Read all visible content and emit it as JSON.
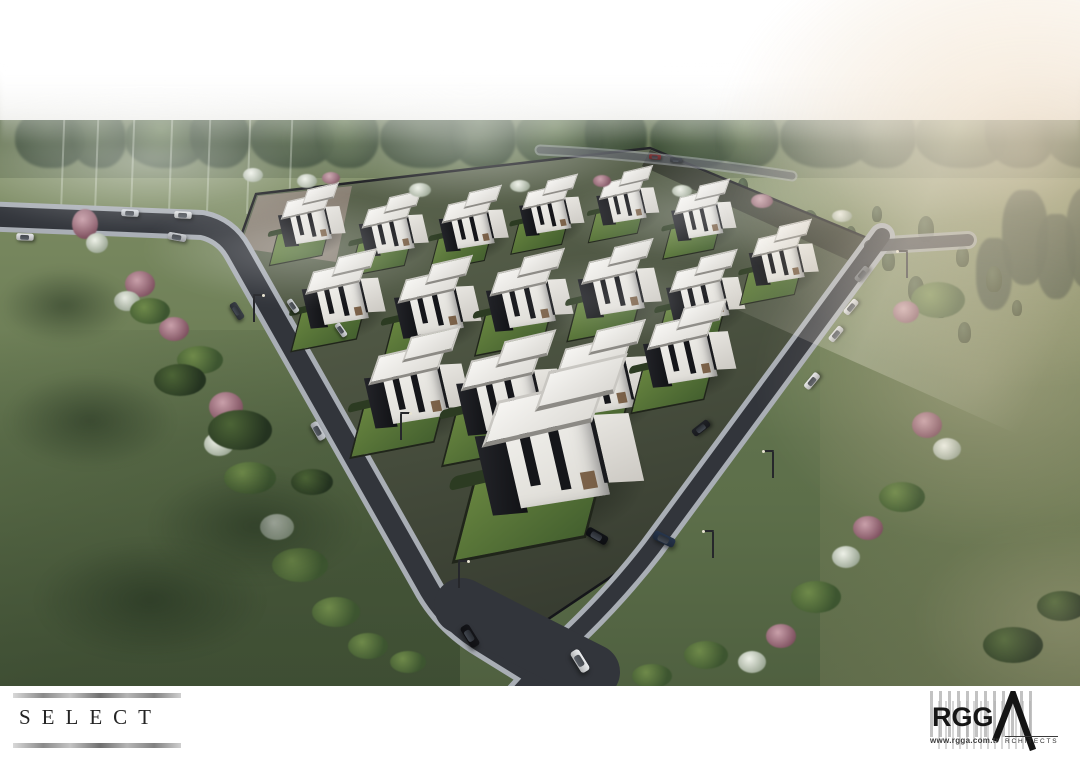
{
  "branding": {
    "select": {
      "label": "SELECT"
    },
    "rgga": {
      "name": "RGG",
      "architects_suffix": "RCHITECTS",
      "website": "www.rgga.com.tr"
    }
  },
  "palette": {
    "sky_white": "#ffffff",
    "fog_warm": "#e7d2b7",
    "grass_light": "#7c8b62",
    "grass_dark": "#4f6040",
    "treeline": "#3d4f35",
    "asphalt": "#32353b",
    "sidewalk": "#a9aeb5",
    "villa_white": "#f2f1ed",
    "villa_dark": "#15161a",
    "lawn_green": "#5d7a42",
    "logo_ink": "#161616"
  },
  "scene": {
    "description": "Aerial 3D architectural rendering of the SELECT villa estate: triangular fenced plot of modern white cubic duplex villas with black accents and flat roofs, wrapped by two diagonal roads with cars and street lamps, set in foggy green meadows with a pine treeline and warm sunlight from the upper right.",
    "villas": [
      {
        "x": 312,
        "y": 224,
        "s": 0.58
      },
      {
        "x": 394,
        "y": 233,
        "s": 0.6
      },
      {
        "x": 474,
        "y": 228,
        "s": 0.6
      },
      {
        "x": 552,
        "y": 214,
        "s": 0.56
      },
      {
        "x": 628,
        "y": 204,
        "s": 0.54
      },
      {
        "x": 704,
        "y": 219,
        "s": 0.56
      },
      {
        "x": 344,
        "y": 300,
        "s": 0.72
      },
      {
        "x": 438,
        "y": 309,
        "s": 0.75
      },
      {
        "x": 530,
        "y": 302,
        "s": 0.75
      },
      {
        "x": 620,
        "y": 290,
        "s": 0.72
      },
      {
        "x": 706,
        "y": 298,
        "s": 0.68
      },
      {
        "x": 784,
        "y": 262,
        "s": 0.6
      },
      {
        "x": 418,
        "y": 392,
        "s": 0.92
      },
      {
        "x": 512,
        "y": 398,
        "s": 0.95
      },
      {
        "x": 604,
        "y": 384,
        "s": 0.9
      },
      {
        "x": 690,
        "y": 356,
        "s": 0.8
      },
      {
        "x": 560,
        "y": 458,
        "s": 1.45
      }
    ],
    "cars": [
      {
        "x": 25,
        "y": 237,
        "a": 2,
        "c": "#e9eaec",
        "s": 0.8
      },
      {
        "x": 130,
        "y": 213,
        "a": 3,
        "c": "#dde1e6",
        "s": 0.8
      },
      {
        "x": 183,
        "y": 215,
        "a": 3,
        "c": "#e7e9eb",
        "s": 0.8
      },
      {
        "x": 177,
        "y": 237,
        "a": 10,
        "c": "#c7cacf",
        "s": 0.85
      },
      {
        "x": 237,
        "y": 311,
        "a": 58,
        "c": "#393e45",
        "s": 0.85
      },
      {
        "x": 318,
        "y": 431,
        "a": 60,
        "c": "#c6cad0",
        "s": 0.9
      },
      {
        "x": 470,
        "y": 636,
        "a": 58,
        "c": "#141519",
        "s": 1.1
      },
      {
        "x": 597,
        "y": 536,
        "a": 30,
        "c": "#111317",
        "s": 1.05
      },
      {
        "x": 664,
        "y": 539,
        "a": 26,
        "c": "#26354c",
        "s": 1.05
      },
      {
        "x": 580,
        "y": 661,
        "a": 58,
        "c": "#eef0f2",
        "s": 1.1
      },
      {
        "x": 862,
        "y": 274,
        "a": -50,
        "c": "#6e737a",
        "s": 0.8
      },
      {
        "x": 851,
        "y": 307,
        "a": -50,
        "c": "#e8eaec",
        "s": 0.8
      },
      {
        "x": 836,
        "y": 334,
        "a": -50,
        "c": "#dfe1e4",
        "s": 0.8
      },
      {
        "x": 812,
        "y": 381,
        "a": -50,
        "c": "#eaecee",
        "s": 0.85
      },
      {
        "x": 701,
        "y": 428,
        "a": -38,
        "c": "#1f2126",
        "s": 0.9
      },
      {
        "x": 341,
        "y": 330,
        "a": 55,
        "c": "#d6d9dc",
        "s": 0.7
      },
      {
        "x": 293,
        "y": 306,
        "a": 55,
        "c": "#ced2d5",
        "s": 0.7
      },
      {
        "x": 655,
        "y": 157,
        "a": 5,
        "c": "#7e2d2f",
        "s": 0.55
      },
      {
        "x": 676,
        "y": 160,
        "a": 5,
        "c": "#3c4148",
        "s": 0.55
      }
    ],
    "lamps": [
      {
        "x": 253,
        "y": 296,
        "f": 1
      },
      {
        "x": 400,
        "y": 414,
        "f": 1
      },
      {
        "x": 458,
        "y": 562,
        "f": 1
      },
      {
        "x": 772,
        "y": 452,
        "f": -1
      },
      {
        "x": 712,
        "y": 532,
        "f": -1
      },
      {
        "x": 906,
        "y": 252,
        "f": -1
      }
    ],
    "bushes": [
      {
        "x": 85,
        "y": 224,
        "w": 26,
        "h": 30,
        "t": "pink"
      },
      {
        "x": 97,
        "y": 243,
        "w": 22,
        "h": 20,
        "t": "white"
      },
      {
        "x": 140,
        "y": 284,
        "w": 30,
        "h": 26,
        "t": "pink"
      },
      {
        "x": 127,
        "y": 301,
        "w": 26,
        "h": 20,
        "t": "white"
      },
      {
        "x": 174,
        "y": 329,
        "w": 30,
        "h": 24,
        "t": "pink"
      },
      {
        "x": 150,
        "y": 311,
        "w": 40,
        "h": 26,
        "t": "green"
      },
      {
        "x": 200,
        "y": 360,
        "w": 46,
        "h": 28,
        "t": "green"
      },
      {
        "x": 226,
        "y": 407,
        "w": 34,
        "h": 30,
        "t": "pink"
      },
      {
        "x": 219,
        "y": 444,
        "w": 30,
        "h": 24,
        "t": "white"
      },
      {
        "x": 250,
        "y": 478,
        "w": 52,
        "h": 32,
        "t": "green"
      },
      {
        "x": 277,
        "y": 527,
        "w": 34,
        "h": 26,
        "t": "white"
      },
      {
        "x": 300,
        "y": 565,
        "w": 56,
        "h": 34,
        "t": "green"
      },
      {
        "x": 336,
        "y": 612,
        "w": 48,
        "h": 30,
        "t": "green"
      },
      {
        "x": 368,
        "y": 646,
        "w": 40,
        "h": 26,
        "t": "green"
      },
      {
        "x": 408,
        "y": 662,
        "w": 36,
        "h": 22,
        "t": "green"
      },
      {
        "x": 240,
        "y": 430,
        "w": 64,
        "h": 40,
        "t": "dark"
      },
      {
        "x": 180,
        "y": 380,
        "w": 52,
        "h": 32,
        "t": "dark"
      },
      {
        "x": 312,
        "y": 482,
        "w": 42,
        "h": 26,
        "t": "dark"
      },
      {
        "x": 90,
        "y": 420,
        "w": 170,
        "h": 95,
        "t": "shadow"
      },
      {
        "x": 255,
        "y": 525,
        "w": 210,
        "h": 115,
        "t": "shadow"
      },
      {
        "x": 65,
        "y": 305,
        "w": 130,
        "h": 75,
        "t": "shadow"
      },
      {
        "x": 150,
        "y": 600,
        "w": 230,
        "h": 120,
        "t": "shadow"
      },
      {
        "x": 253,
        "y": 175,
        "w": 20,
        "h": 14,
        "t": "white"
      },
      {
        "x": 307,
        "y": 181,
        "w": 20,
        "h": 14,
        "t": "white"
      },
      {
        "x": 331,
        "y": 178,
        "w": 18,
        "h": 12,
        "t": "pink"
      },
      {
        "x": 420,
        "y": 190,
        "w": 22,
        "h": 14,
        "t": "white"
      },
      {
        "x": 520,
        "y": 186,
        "w": 20,
        "h": 12,
        "t": "white"
      },
      {
        "x": 602,
        "y": 181,
        "w": 18,
        "h": 12,
        "t": "pink"
      },
      {
        "x": 682,
        "y": 191,
        "w": 20,
        "h": 12,
        "t": "white"
      },
      {
        "x": 762,
        "y": 201,
        "w": 22,
        "h": 14,
        "t": "pink"
      },
      {
        "x": 842,
        "y": 216,
        "w": 20,
        "h": 12,
        "t": "white"
      },
      {
        "x": 938,
        "y": 300,
        "w": 54,
        "h": 36,
        "t": "green"
      },
      {
        "x": 906,
        "y": 312,
        "w": 26,
        "h": 22,
        "t": "pink"
      },
      {
        "x": 927,
        "y": 425,
        "w": 30,
        "h": 26,
        "t": "pink"
      },
      {
        "x": 947,
        "y": 449,
        "w": 28,
        "h": 22,
        "t": "white"
      },
      {
        "x": 902,
        "y": 497,
        "w": 46,
        "h": 30,
        "t": "green"
      },
      {
        "x": 868,
        "y": 528,
        "w": 30,
        "h": 24,
        "t": "pink"
      },
      {
        "x": 846,
        "y": 557,
        "w": 28,
        "h": 22,
        "t": "white"
      },
      {
        "x": 816,
        "y": 597,
        "w": 50,
        "h": 32,
        "t": "green"
      },
      {
        "x": 781,
        "y": 636,
        "w": 30,
        "h": 24,
        "t": "pink"
      },
      {
        "x": 752,
        "y": 662,
        "w": 28,
        "h": 22,
        "t": "white"
      },
      {
        "x": 706,
        "y": 655,
        "w": 44,
        "h": 28,
        "t": "green"
      },
      {
        "x": 652,
        "y": 676,
        "w": 40,
        "h": 24,
        "t": "green"
      },
      {
        "x": 1013,
        "y": 645,
        "w": 60,
        "h": 36,
        "t": "dark"
      },
      {
        "x": 1062,
        "y": 606,
        "w": 50,
        "h": 30,
        "t": "dark"
      }
    ],
    "treeline": [
      {
        "x": 15,
        "w": 70,
        "h": 58,
        "c": 0
      },
      {
        "x": 70,
        "w": 56,
        "h": 64,
        "c": 1
      },
      {
        "x": 125,
        "w": 80,
        "h": 56,
        "c": 2
      },
      {
        "x": 190,
        "w": 60,
        "h": 66,
        "c": 0
      },
      {
        "x": 250,
        "w": 84,
        "h": 60,
        "c": 1
      },
      {
        "x": 315,
        "w": 64,
        "h": 70,
        "c": 2
      },
      {
        "x": 380,
        "w": 88,
        "h": 58,
        "c": 0
      },
      {
        "x": 450,
        "w": 66,
        "h": 66,
        "c": 1
      },
      {
        "x": 515,
        "w": 90,
        "h": 60,
        "c": 2
      },
      {
        "x": 585,
        "w": 62,
        "h": 68,
        "c": 0
      },
      {
        "x": 650,
        "w": 86,
        "h": 58,
        "c": 1
      },
      {
        "x": 715,
        "w": 64,
        "h": 64,
        "c": 2
      },
      {
        "x": 780,
        "w": 90,
        "h": 60,
        "c": 0
      },
      {
        "x": 850,
        "w": 66,
        "h": 70,
        "c": 1
      },
      {
        "x": 915,
        "w": 92,
        "h": 62,
        "c": 2
      },
      {
        "x": 985,
        "w": 70,
        "h": 74,
        "c": 0
      },
      {
        "x": 1045,
        "w": 80,
        "h": 64,
        "c": 1
      }
    ],
    "tall_trees": [
      {
        "x": 1002,
        "y": 190,
        "w": 46,
        "h": 95
      },
      {
        "x": 1036,
        "y": 214,
        "w": 40,
        "h": 85
      },
      {
        "x": 1066,
        "y": 188,
        "w": 44,
        "h": 100
      },
      {
        "x": 976,
        "y": 238,
        "w": 36,
        "h": 72
      }
    ],
    "conifers": [
      {
        "x": 390,
        "y": 185
      },
      {
        "x": 445,
        "y": 178
      },
      {
        "x": 500,
        "y": 190
      },
      {
        "x": 560,
        "y": 176
      },
      {
        "x": 622,
        "y": 186
      },
      {
        "x": 700,
        "y": 186
      },
      {
        "x": 738,
        "y": 178
      },
      {
        "x": 762,
        "y": 196
      },
      {
        "x": 802,
        "y": 210
      },
      {
        "x": 846,
        "y": 226
      },
      {
        "x": 882,
        "y": 250
      },
      {
        "x": 908,
        "y": 276
      },
      {
        "x": 936,
        "y": 302
      },
      {
        "x": 956,
        "y": 246
      },
      {
        "x": 986,
        "y": 266
      },
      {
        "x": 1012,
        "y": 300
      },
      {
        "x": 958,
        "y": 322
      },
      {
        "x": 918,
        "y": 216
      },
      {
        "x": 872,
        "y": 206
      },
      {
        "x": 680,
        "y": 205
      }
    ],
    "trunks": [
      62,
      96,
      132,
      170,
      208,
      248,
      290
    ],
    "fog_cool": [
      {
        "x": 150,
        "y": 160,
        "w": 460,
        "h": 150,
        "o": 0.55
      },
      {
        "x": 470,
        "y": 140,
        "w": 380,
        "h": 130,
        "o": 0.5
      },
      {
        "x": 300,
        "y": 250,
        "w": 320,
        "h": 110,
        "o": 0.32
      },
      {
        "x": 700,
        "y": 215,
        "w": 300,
        "h": 100,
        "o": 0.3
      },
      {
        "x": 620,
        "y": 300,
        "w": 260,
        "h": 90,
        "o": 0.2
      },
      {
        "x": 870,
        "y": 130,
        "w": 520,
        "h": 200,
        "o": 0.5
      }
    ],
    "fog_warm": [
      {
        "x": 1030,
        "y": 150,
        "w": 640,
        "h": 480,
        "o": 0.7
      },
      {
        "x": 980,
        "y": 380,
        "w": 460,
        "h": 340,
        "o": 0.35
      },
      {
        "x": 1060,
        "y": 620,
        "w": 300,
        "h": 200,
        "o": 0.2
      }
    ]
  }
}
